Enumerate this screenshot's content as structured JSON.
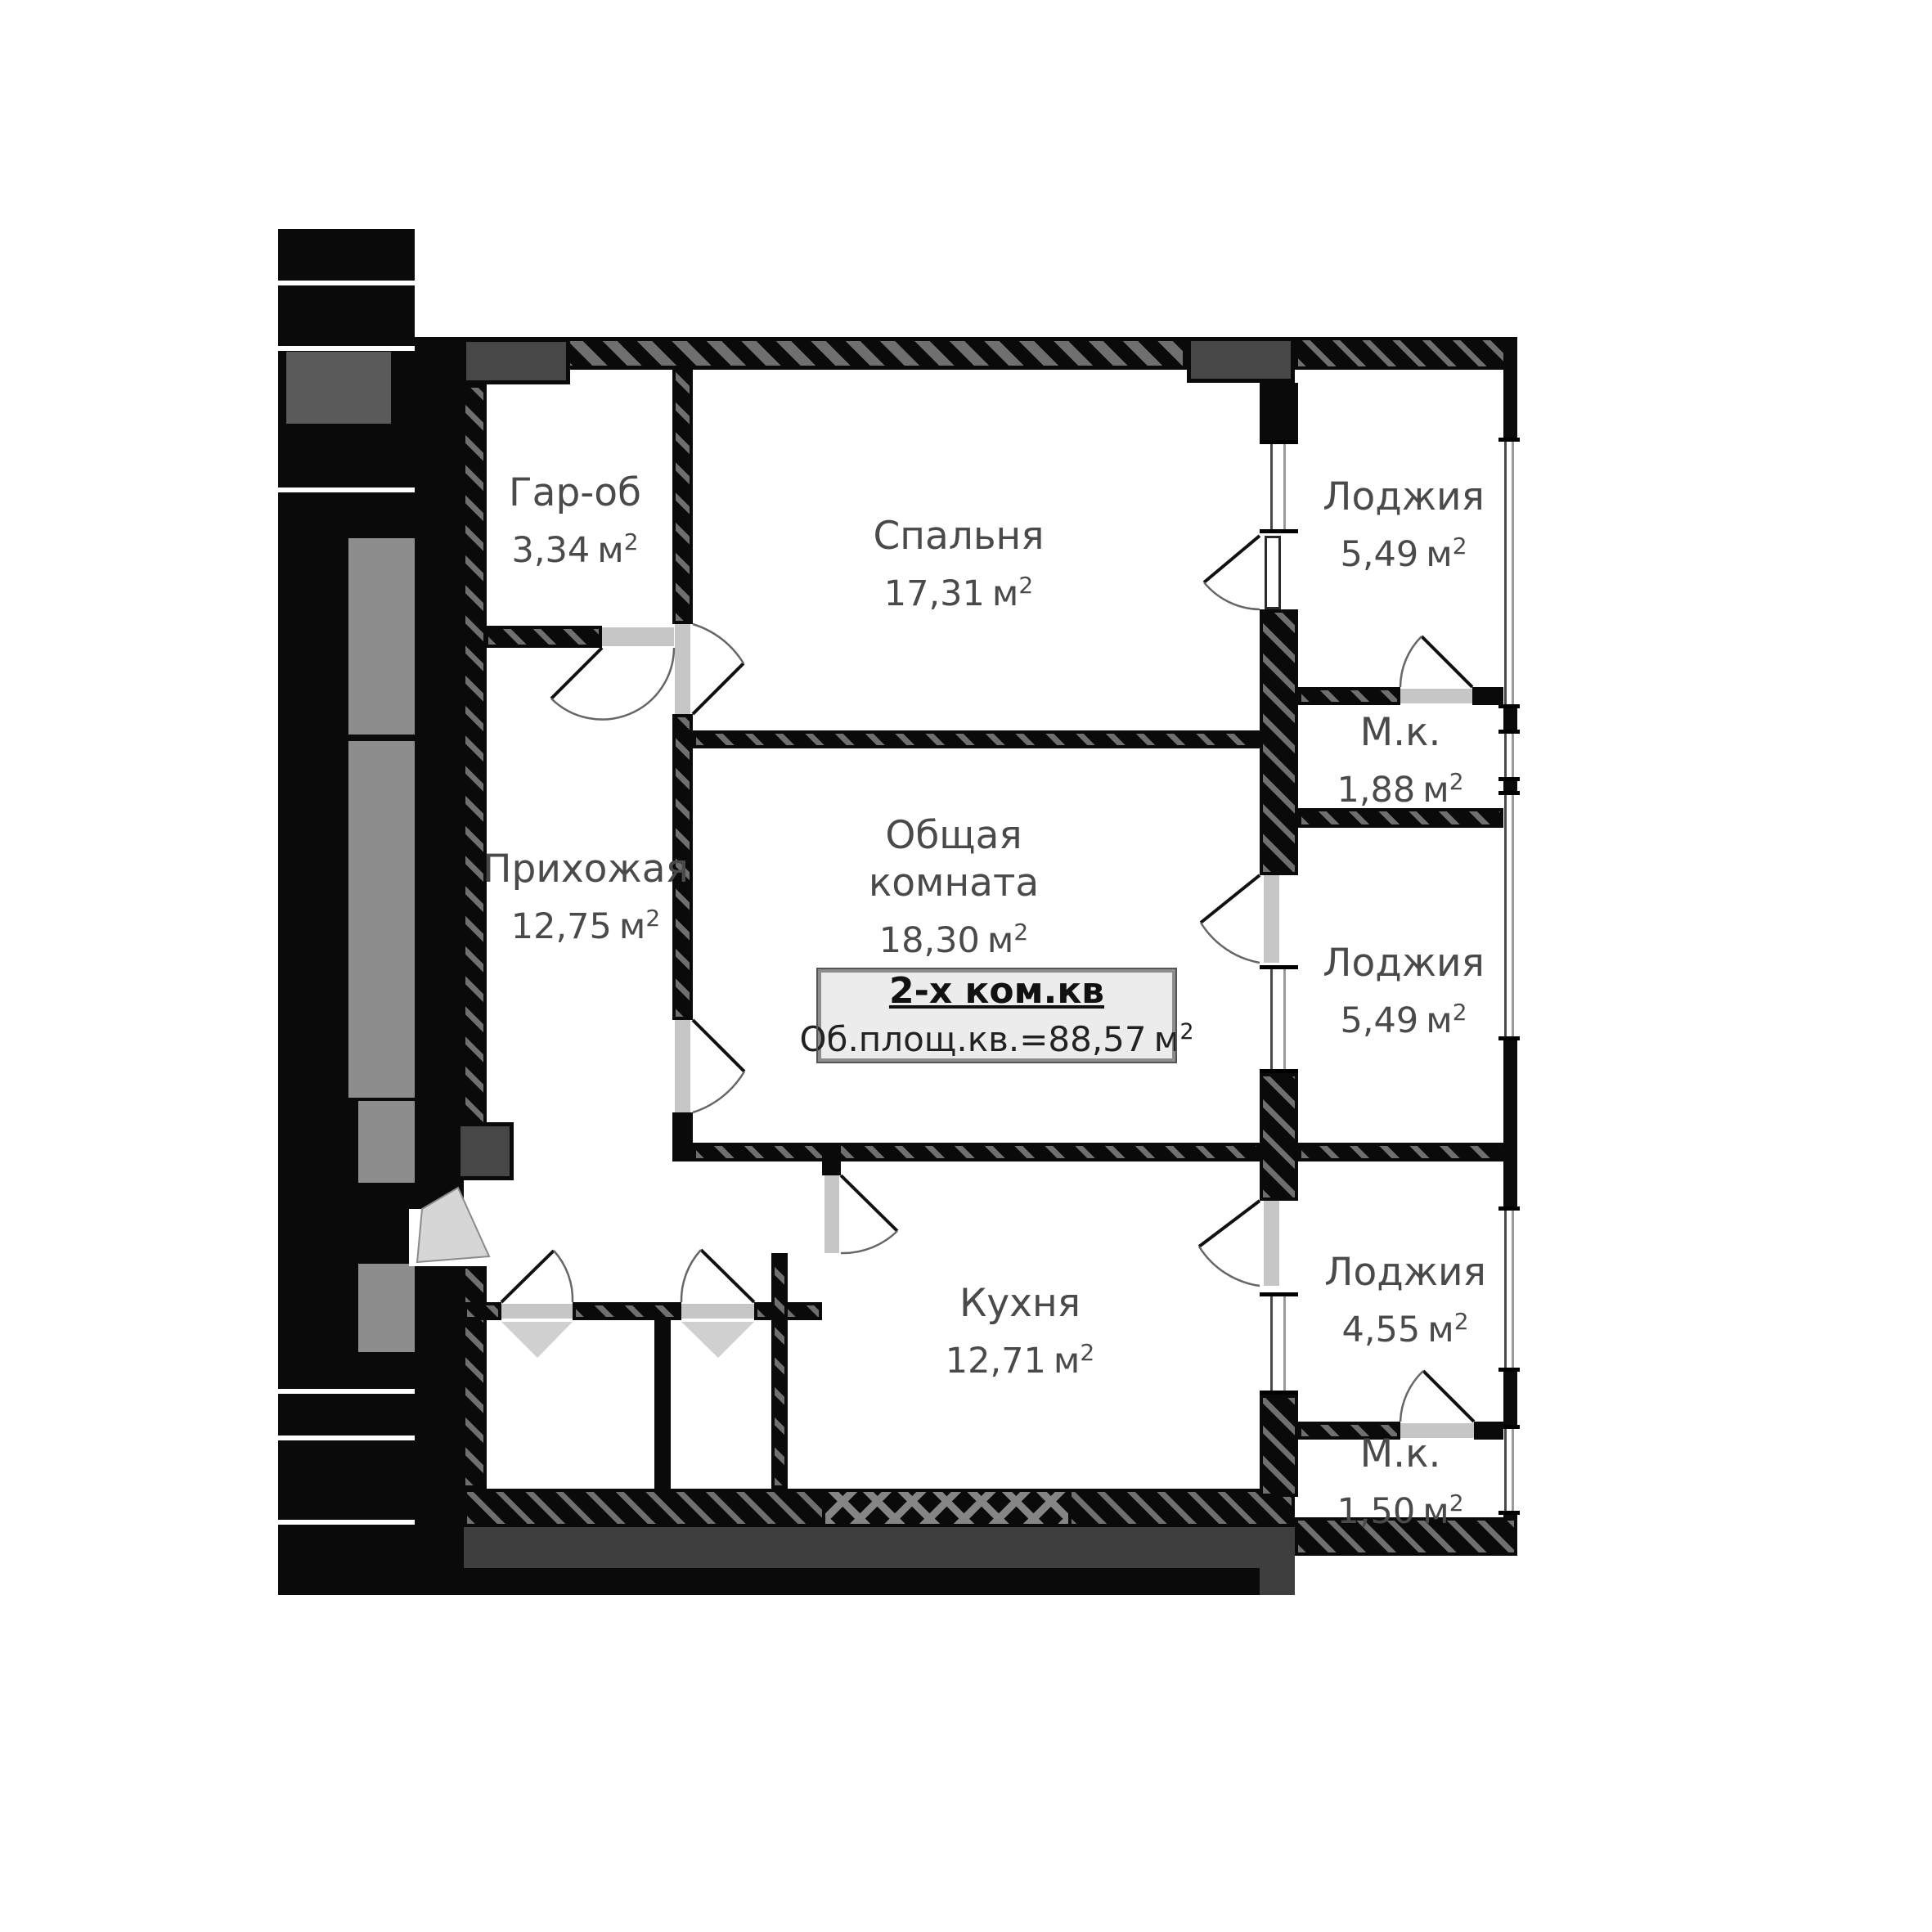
{
  "plan": {
    "unit": "м",
    "unit_sup": "2",
    "info_box": {
      "title": "2-х ком.кв",
      "total_area_text": "Об.площ.кв.=88,57"
    },
    "rooms": [
      {
        "id": "garob",
        "name": "Гар-об",
        "area": "3,34"
      },
      {
        "id": "bedroom",
        "name": "Спальня",
        "area": "17,31"
      },
      {
        "id": "loggia-top",
        "name": "Лоджия",
        "area": "5,49"
      },
      {
        "id": "mk-top",
        "name": "М.к.",
        "area": "1,88"
      },
      {
        "id": "living",
        "name": "Общая комната",
        "area": "18,30"
      },
      {
        "id": "hallway",
        "name": "Прихожая",
        "area": "12,75"
      },
      {
        "id": "loggia-middle",
        "name": "Лоджия",
        "area": "5,49"
      },
      {
        "id": "kitchen",
        "name": "Кухня",
        "area": "12,71"
      },
      {
        "id": "loggia-bottom",
        "name": "Лоджия",
        "area": "4,55"
      },
      {
        "id": "mk-bottom",
        "name": "М.к.",
        "area": "1,50"
      }
    ],
    "colors": {
      "wall": "#0a0a0a",
      "hatch": "#6f6f6f",
      "door_leaf": "#c6c6c6",
      "lower_band": "#3e3e3e",
      "info_box_bg": "#ececec",
      "label_text": "#4a4a4a"
    }
  }
}
